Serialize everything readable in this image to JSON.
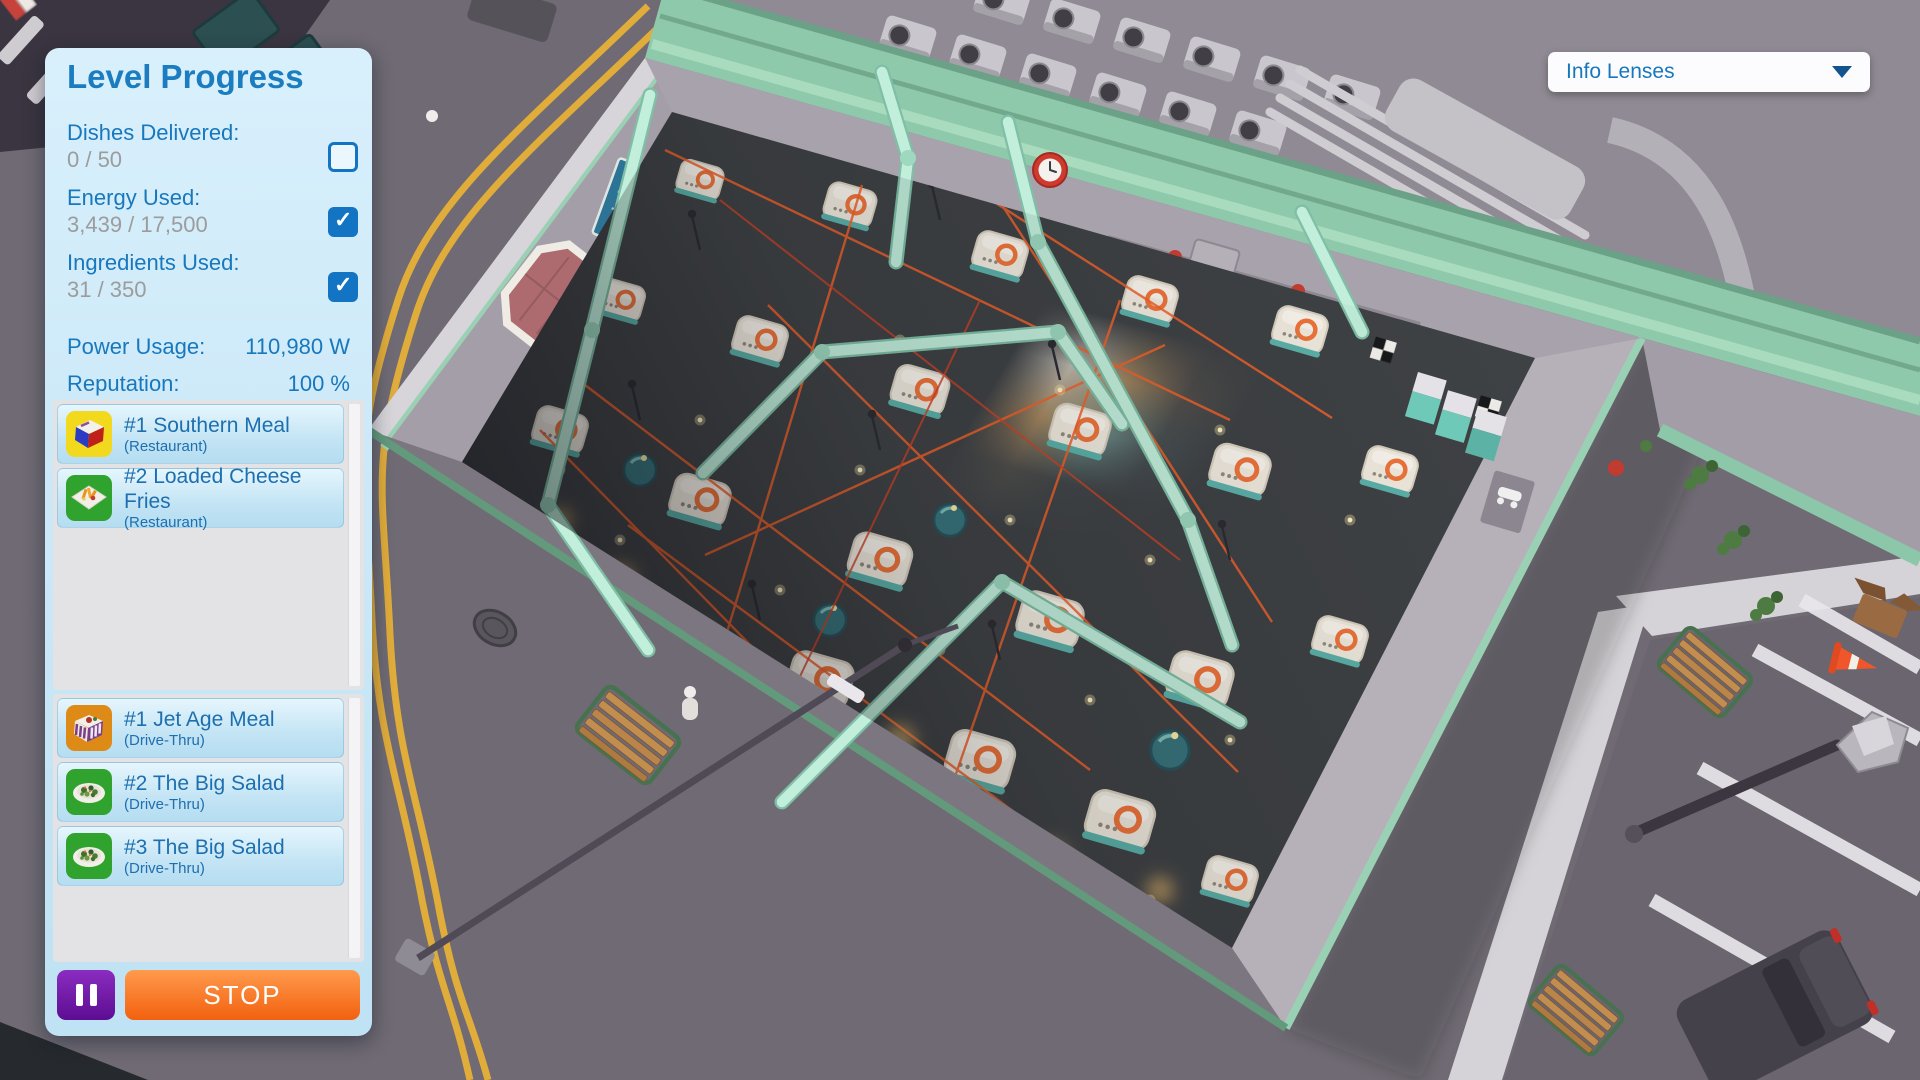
{
  "panel": {
    "title": "Level Progress",
    "stats": [
      {
        "label": "Dishes Delivered:",
        "value": "0 / 50",
        "checked": false
      },
      {
        "label": "Energy Used:",
        "value": "3,439 / 17,500",
        "checked": true
      },
      {
        "label": "Ingredients Used:",
        "value": "31 / 350",
        "checked": true
      }
    ],
    "metrics": [
      {
        "label": "Power Usage:",
        "value": "110,980 W"
      },
      {
        "label": "Reputation:",
        "value": "100 %"
      }
    ],
    "restaurant_orders": [
      {
        "name": "#1 Southern Meal",
        "venue": "(Restaurant)",
        "icon": "combo-box",
        "icon_bg": "#f2d91d"
      },
      {
        "name": "#2 Loaded Cheese Fries",
        "venue": "(Restaurant)",
        "icon": "fries-plate",
        "icon_bg": "#2fa32d"
      }
    ],
    "drive_thru_orders": [
      {
        "name": "#1 Jet Age Meal",
        "venue": "(Drive-Thru)",
        "icon": "jet-box",
        "icon_bg": "#de8a16"
      },
      {
        "name": "#2 The Big Salad",
        "venue": "(Drive-Thru)",
        "icon": "salad-plate",
        "icon_bg": "#2fa32d"
      },
      {
        "name": "#3 The Big Salad",
        "venue": "(Drive-Thru)",
        "icon": "salad-plate",
        "icon_bg": "#2fa32d"
      }
    ],
    "stop_label": "STOP"
  },
  "hud": {
    "info_lenses_label": "Info Lenses"
  },
  "colors": {
    "ui_blue": "#1878be",
    "ui_value_gray": "#9c9c9c",
    "checkbox_blue": "#1474c4",
    "pause_purple": "#6d17a3",
    "stop_orange": "#f2610f",
    "roof_mint": "#8fc9ac",
    "brick_pink": "#b4747a",
    "road_gray": "#6f6a73",
    "machine_cream": "#f1ebdf",
    "machine_orange": "#f0743a",
    "pipe_mint": "#c2efdc",
    "conveyor_tan": "#c79d5f"
  }
}
